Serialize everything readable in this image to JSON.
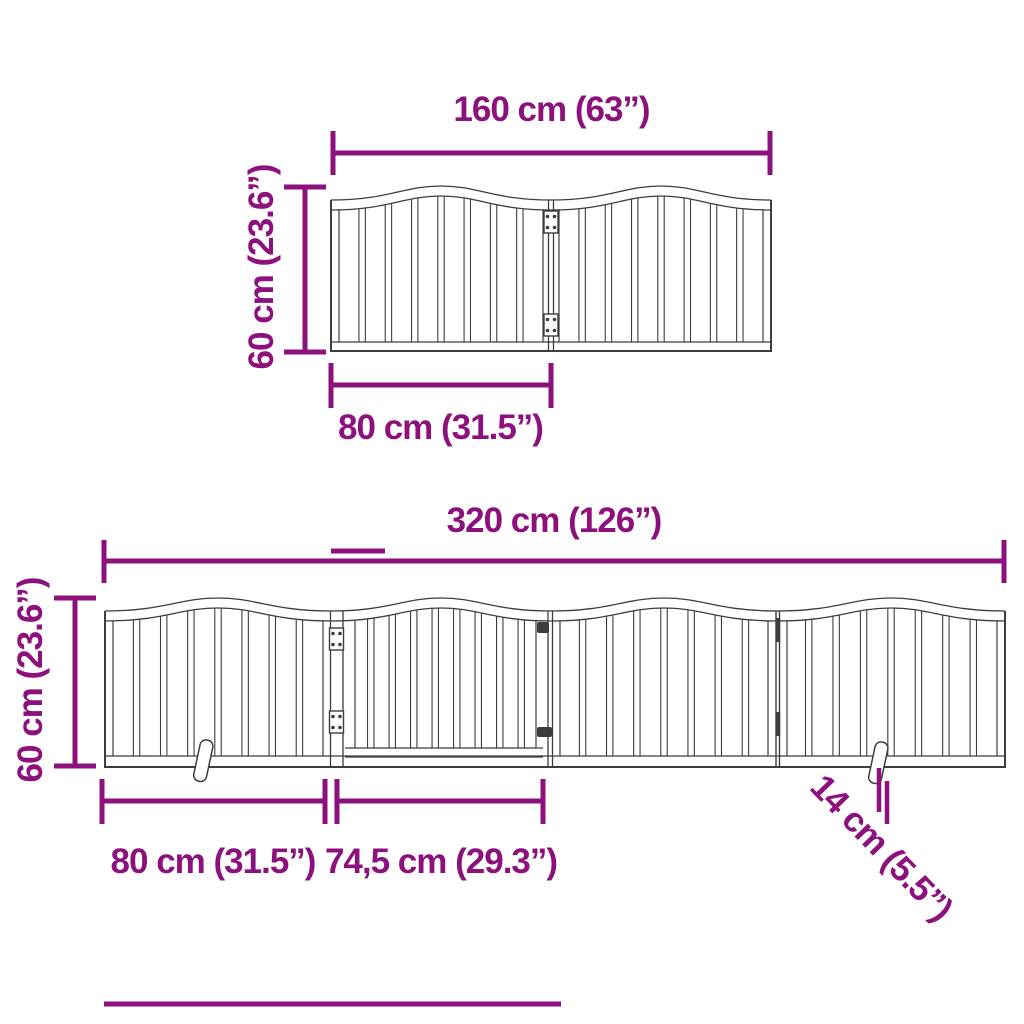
{
  "colors": {
    "dimension_accent": "#8C117C",
    "drawing_line": "#3D3D3D",
    "background": "#FFFFFF"
  },
  "top_gate": {
    "panel_count": 2,
    "width_label": "160 cm (63”)",
    "height_label": "60 cm (23.6”)",
    "panel_width_label": "80 cm (31.5”)"
  },
  "bottom_gate": {
    "panel_count": 4,
    "width_label": "320 cm (126”)",
    "height_label": "60 cm (23.6”)",
    "panel_width_label": "80 cm (31.5”)",
    "door_width_label": "74,5 cm (29.3”)",
    "foot_depth_label": "14 cm (5.5”)"
  }
}
